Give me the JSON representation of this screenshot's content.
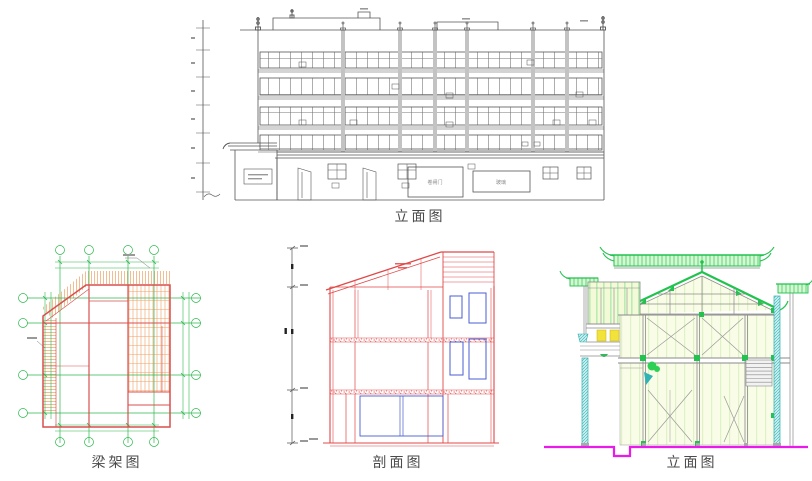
{
  "page": {
    "background_color": "#ffffff"
  },
  "drawings": {
    "top_elevation": {
      "caption": "立面图",
      "line_color": "#555555",
      "storefront_sign_1": "卷闸门",
      "storefront_sign_2": "玻璃"
    },
    "beam_plan": {
      "caption": "梁架图",
      "beam_color": "#d94f4f",
      "grid_color": "#2db84d",
      "hatch_color": "#f0a060"
    },
    "section": {
      "caption": "剖面图",
      "line_color": "#e04848",
      "window_color": "#4a5cd0"
    },
    "right_elevation": {
      "caption": "立面图",
      "roof_color": "#22c24e",
      "panel_color": "#f8fbe2",
      "column_color": "#2fb3b3",
      "accent_yellow": "#f2e23c",
      "ground_color": "#ea1bea"
    }
  }
}
